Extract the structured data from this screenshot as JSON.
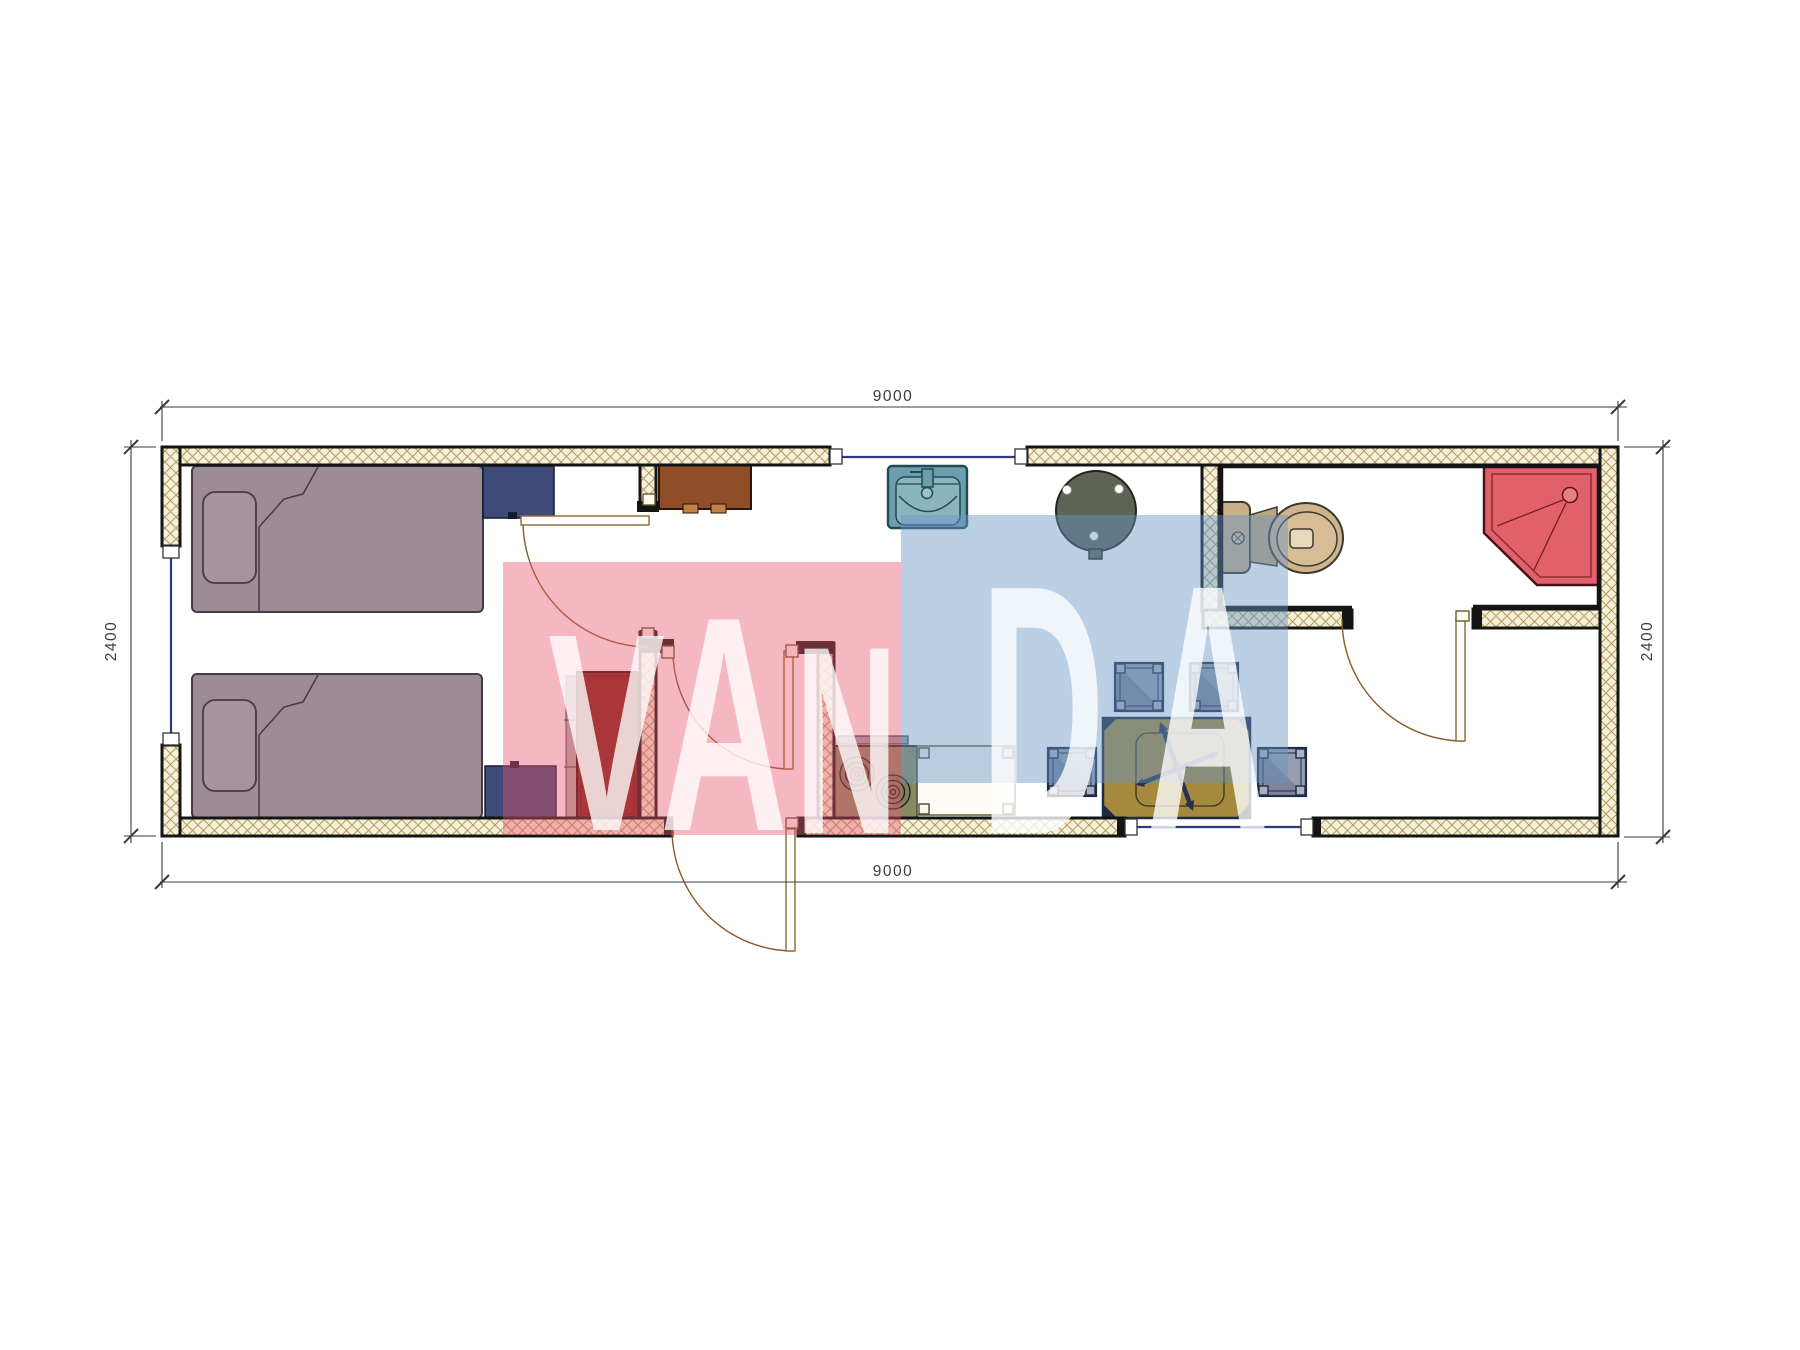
{
  "watermark": {
    "text": "VANDA",
    "letters": [
      "V",
      "A",
      "N",
      "D",
      "A"
    ],
    "pink_color": "#e75670",
    "blue_color": "#6895c6"
  },
  "dimensions": {
    "top": "9000",
    "bottom": "9000",
    "left": "2400",
    "right": "2400"
  },
  "plan": {
    "wall_hatch_bg": "#f6f0da",
    "wall_hatch_line": "#b3a05e",
    "wall_outline": "#141414",
    "window_line": "#2c3a80",
    "door_line": "#8a5a26"
  },
  "furniture": [
    {
      "name": "single-bed-1",
      "color": "#9c8c95"
    },
    {
      "name": "single-bed-2",
      "color": "#9c8c95"
    },
    {
      "name": "nightstand-1",
      "color": "#3e4a78"
    },
    {
      "name": "nightstand-2",
      "color": "#3e4a78"
    },
    {
      "name": "cabinet",
      "color": "#8f4d28"
    },
    {
      "name": "wardrobe",
      "color": "#7e2012"
    },
    {
      "name": "stove",
      "color": "#8a8a62"
    },
    {
      "name": "kitchen-counter",
      "color": "#fbf8ee"
    },
    {
      "name": "sink",
      "color": "#6f9dab"
    },
    {
      "name": "round-table",
      "color": "#5d6355"
    },
    {
      "name": "dining-table",
      "color": "#a5893c"
    },
    {
      "name": "ceiling-fan",
      "color": "#27314e"
    },
    {
      "name": "stool",
      "count": 4,
      "color": "#959dae"
    },
    {
      "name": "toilet",
      "color": "#c9ae87"
    },
    {
      "name": "shower",
      "color": "#e2606a"
    }
  ]
}
